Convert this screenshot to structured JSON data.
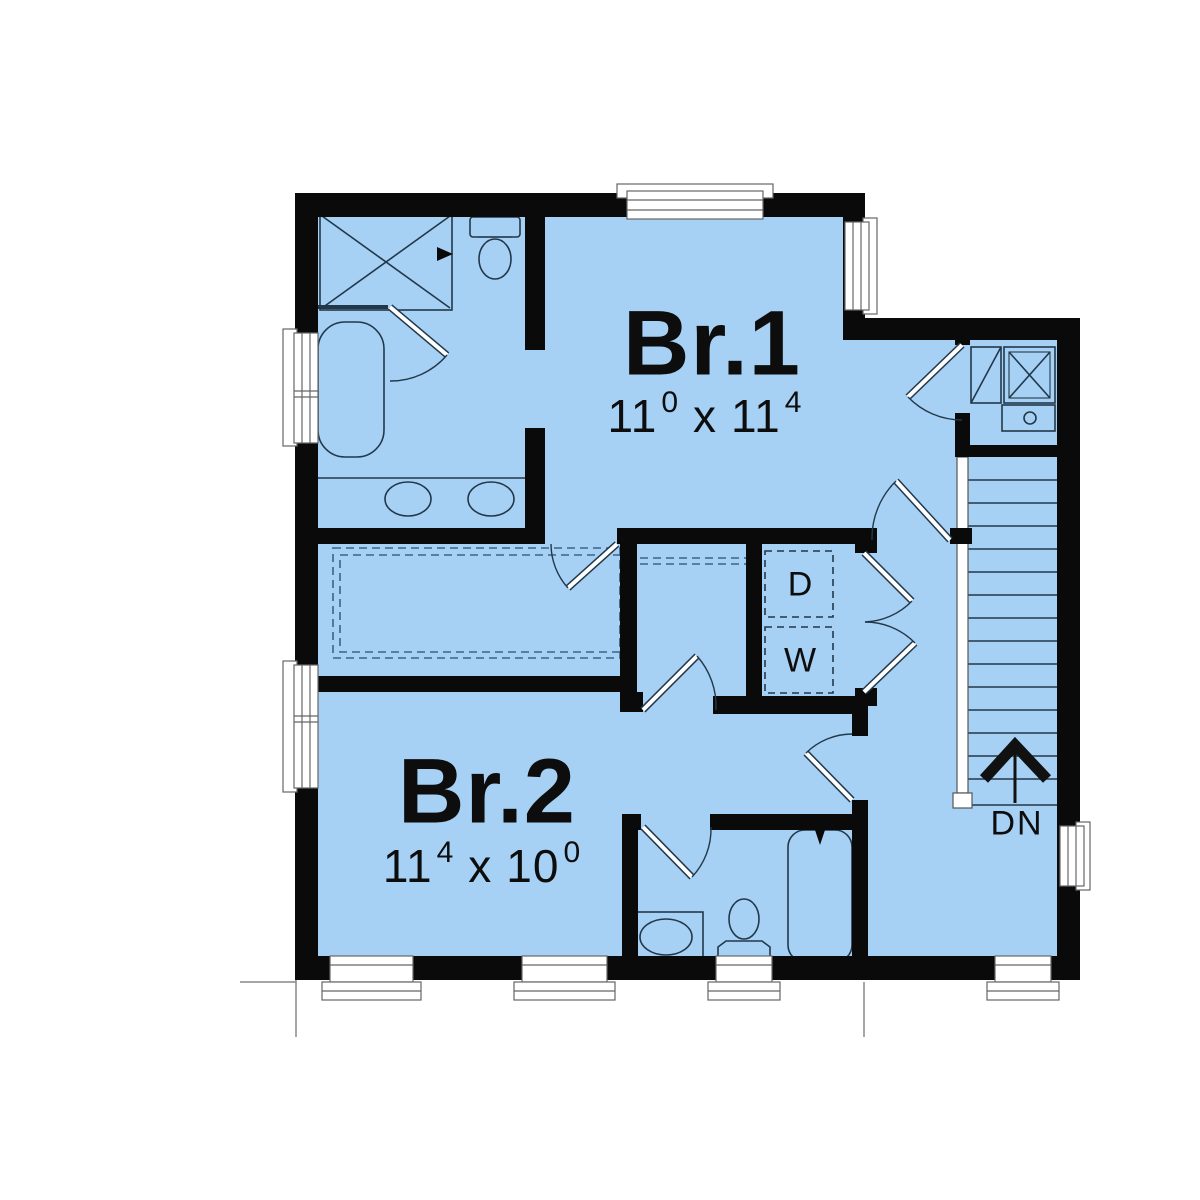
{
  "plan": {
    "type": "second-floor residential floor plan",
    "rooms": {
      "br1": {
        "name": "Br.1",
        "dim": {
          "a": "11",
          "a_sup": "0",
          "sep": "x",
          "b": "11",
          "b_sup": "4"
        }
      },
      "br2": {
        "name": "Br.2",
        "dim": {
          "a": "11",
          "a_sup": "4",
          "sep": "x",
          "b": "10",
          "b_sup": "0"
        }
      }
    },
    "laundry": {
      "dryer_label": "D",
      "washer_label": "W"
    },
    "stairs": {
      "direction_label": "DN"
    },
    "fixtures": [
      "shower",
      "toilet",
      "bathtub",
      "double-vanity-sinks",
      "pedestal-sink",
      "washer",
      "dryer",
      "water-heater",
      "furnace"
    ],
    "colors": {
      "floor_fill": "#a6d1f4",
      "wall": "#0a0a0a",
      "fixture_line": "#22384a",
      "shelf_dash": "#3e6283",
      "window_frame": "#666666",
      "label_text": "#0d0d0d"
    }
  }
}
